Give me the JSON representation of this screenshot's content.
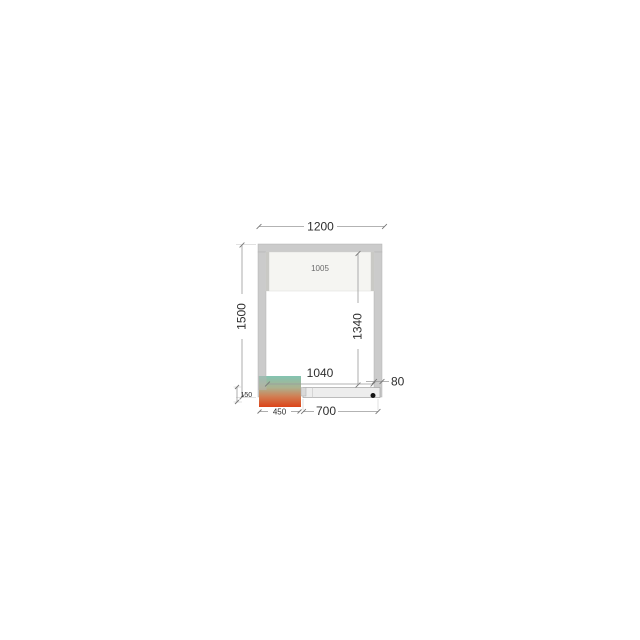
{
  "drawing": {
    "type": "cold-room-floor-plan-dimension-diagram",
    "labels": {
      "outer_width_mm": "1200",
      "outer_depth_mm": "1500",
      "door_panel_mm": "1005",
      "inner_depth_mm": "1340",
      "inner_width_mm": "1040",
      "wall_thickness_mm": "80",
      "unit_overhang_mm": "150",
      "unit_width_mm": "450",
      "bottom_panel_mm": "700"
    },
    "colors": {
      "background": "#ffffff",
      "wall_fill": "#cbcbcb",
      "wall_stroke": "#b2b2b2",
      "door_panel_fill": "#f5f5f2",
      "door_panel_edge": "#c9c9c5",
      "bottom_bar_fill": "#ededed",
      "bottom_bar_stroke": "#a3a3a3",
      "dimension_line": "#9a9a9a",
      "text_dark": "#2e2e2e",
      "text_light": "#6a6a6a",
      "drain_dot": "#141414",
      "unit_gradient_top": "#83c4b1",
      "unit_gradient_mid1": "#adb18e",
      "unit_gradient_mid2": "#d08055",
      "unit_gradient_bottom": "#dc4419",
      "corner_overlay": "#b5b5b5",
      "pipe_tab_fill": "#d9d9d9"
    }
  }
}
